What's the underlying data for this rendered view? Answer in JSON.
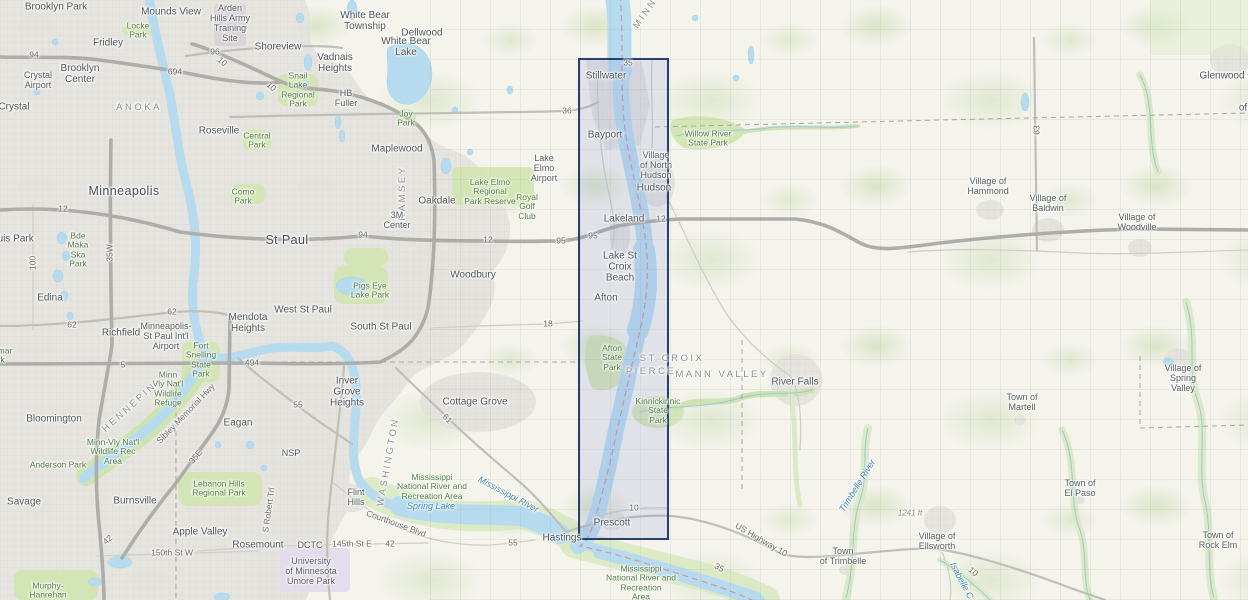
{
  "map": {
    "selection": {
      "border_color": "#24406e",
      "fill_color": "rgba(131,142,212,0.17)"
    },
    "labels": [
      {
        "t": "Brooklyn Park",
        "x": 56,
        "y": 7,
        "c": "city"
      },
      {
        "t": "Mounds View",
        "x": 171,
        "y": 12,
        "c": "city"
      },
      {
        "t": "Arden\nHills Army\nTraining\nSite",
        "x": 230,
        "y": 24,
        "c": "town"
      },
      {
        "t": "Fridley",
        "x": 108,
        "y": 43,
        "c": "city"
      },
      {
        "t": "Locke\nPark",
        "x": 138,
        "y": 31,
        "c": "park"
      },
      {
        "t": "Shoreview",
        "x": 278,
        "y": 47,
        "c": "city"
      },
      {
        "t": "Brooklyn\nCenter",
        "x": 80,
        "y": 74,
        "c": "city"
      },
      {
        "t": "Crystal\nAirport",
        "x": 38,
        "y": 81,
        "c": "town"
      },
      {
        "t": "Crystal",
        "x": 14,
        "y": 107,
        "c": "city"
      },
      {
        "t": "ANOKA",
        "x": 139,
        "y": 108,
        "c": "county"
      },
      {
        "t": "Snail\nLake\nRegional\nPark",
        "x": 298,
        "y": 90,
        "c": "park"
      },
      {
        "t": "White Bear\nTownship",
        "x": 365,
        "y": 21,
        "c": "city"
      },
      {
        "t": "Dellwood",
        "x": 422,
        "y": 33,
        "c": "city"
      },
      {
        "t": "White Bear\nLake",
        "x": 406,
        "y": 47,
        "c": "city"
      },
      {
        "t": "Vadnais\nHeights",
        "x": 335,
        "y": 63,
        "c": "city"
      },
      {
        "t": "HB\nFuller",
        "x": 346,
        "y": 99,
        "c": "town"
      },
      {
        "t": "Joy\nPark",
        "x": 406,
        "y": 119,
        "c": "park"
      },
      {
        "t": "94",
        "x": 34,
        "y": 55,
        "c": "road"
      },
      {
        "t": "694",
        "x": 175,
        "y": 72,
        "c": "road"
      },
      {
        "t": "96",
        "x": 215,
        "y": 52,
        "c": "road"
      },
      {
        "t": "10",
        "x": 222,
        "y": 62,
        "c": "road",
        "r": 40
      },
      {
        "t": "10",
        "x": 271,
        "y": 87,
        "c": "road",
        "r": 40
      },
      {
        "t": "MINN",
        "x": 646,
        "y": 14,
        "c": "county",
        "r": -55
      },
      {
        "t": "35",
        "x": 628,
        "y": 63,
        "c": "road"
      },
      {
        "t": "36",
        "x": 567,
        "y": 111,
        "c": "road"
      },
      {
        "t": "Stillwater",
        "x": 606,
        "y": 76,
        "c": "city"
      },
      {
        "t": "Bayport",
        "x": 605,
        "y": 135,
        "c": "city"
      },
      {
        "t": "Village\nof North\nHudson",
        "x": 656,
        "y": 166,
        "c": "town"
      },
      {
        "t": "Hudson",
        "x": 654,
        "y": 188,
        "c": "city"
      },
      {
        "t": "Willow River\nState Park",
        "x": 708,
        "y": 139,
        "c": "park"
      },
      {
        "t": "Maplewood",
        "x": 397,
        "y": 149,
        "c": "city"
      },
      {
        "t": "Roseville",
        "x": 219,
        "y": 131,
        "c": "city"
      },
      {
        "t": "Central\nPark",
        "x": 257,
        "y": 141,
        "c": "park"
      },
      {
        "t": "Como\nPark",
        "x": 243,
        "y": 197,
        "c": "park"
      },
      {
        "t": "Minneapolis",
        "x": 124,
        "y": 192,
        "c": "city-lg"
      },
      {
        "t": "St Paul",
        "x": 287,
        "y": 241,
        "c": "city-lg"
      },
      {
        "t": "RAMSEY",
        "x": 403,
        "y": 193,
        "c": "county",
        "r": -90
      },
      {
        "t": "Oakdale",
        "x": 437,
        "y": 201,
        "c": "city"
      },
      {
        "t": "Lake Elmo\nRegional\nPark Reserve",
        "x": 490,
        "y": 192,
        "c": "park"
      },
      {
        "t": "Lake\nElmo\nAirport",
        "x": 544,
        "y": 169,
        "c": "town"
      },
      {
        "t": "Royal\nGolf\nClub",
        "x": 527,
        "y": 207,
        "c": "park"
      },
      {
        "t": "3M\nCenter",
        "x": 397,
        "y": 221,
        "c": "town"
      },
      {
        "t": "12",
        "x": 63,
        "y": 209,
        "c": "road"
      },
      {
        "t": "35W",
        "x": 110,
        "y": 253,
        "c": "road",
        "r": -90
      },
      {
        "t": "100",
        "x": 33,
        "y": 263,
        "c": "road",
        "r": -90
      },
      {
        "t": "Bde\nMaka\nSka\nPark",
        "x": 78,
        "y": 250,
        "c": "park"
      },
      {
        "t": "St Louis Park",
        "x": 4,
        "y": 239,
        "c": "city"
      },
      {
        "t": "94",
        "x": 363,
        "y": 235,
        "c": "road"
      },
      {
        "t": "12",
        "x": 488,
        "y": 240,
        "c": "road"
      },
      {
        "t": "95",
        "x": 561,
        "y": 241,
        "c": "road"
      },
      {
        "t": "95",
        "x": 593,
        "y": 236,
        "c": "road"
      },
      {
        "t": "12",
        "x": 661,
        "y": 219,
        "c": "road"
      },
      {
        "t": "Lakeland",
        "x": 624,
        "y": 219,
        "c": "city"
      },
      {
        "t": "Woodbury",
        "x": 473,
        "y": 275,
        "c": "city"
      },
      {
        "t": "Pigs Eye\nLake Park",
        "x": 370,
        "y": 291,
        "c": "park"
      },
      {
        "t": "Lake St\nCroix\nBeach",
        "x": 620,
        "y": 267,
        "c": "city"
      },
      {
        "t": "Edina",
        "x": 50,
        "y": 298,
        "c": "city"
      },
      {
        "t": "62",
        "x": 72,
        "y": 325,
        "c": "road"
      },
      {
        "t": "62",
        "x": 172,
        "y": 312,
        "c": "road"
      },
      {
        "t": "Richfield",
        "x": 121,
        "y": 333,
        "c": "city"
      },
      {
        "t": "Minneapolis-\nSt Paul Int'l\nAirport",
        "x": 166,
        "y": 337,
        "c": "town"
      },
      {
        "t": "Mendota\nHeights",
        "x": 248,
        "y": 323,
        "c": "city"
      },
      {
        "t": "West St Paul",
        "x": 303,
        "y": 310,
        "c": "city"
      },
      {
        "t": "South St Paul",
        "x": 381,
        "y": 327,
        "c": "city"
      },
      {
        "t": "Afton",
        "x": 606,
        "y": 298,
        "c": "city"
      },
      {
        "t": "18",
        "x": 548,
        "y": 324,
        "c": "road"
      },
      {
        "t": "Fort\nSnelling\nState\nPark",
        "x": 201,
        "y": 360,
        "c": "park"
      },
      {
        "t": "Minn\nVly Nat'l\nWildlife\nRefuge",
        "x": 168,
        "y": 389,
        "c": "park"
      },
      {
        "t": "494",
        "x": 252,
        "y": 363,
        "c": "road"
      },
      {
        "t": "5",
        "x": 123,
        "y": 365,
        "c": "road"
      },
      {
        "t": "Braemar\nPark",
        "x": -4,
        "y": 356,
        "c": "park"
      },
      {
        "t": "Inver\nGrove\nHeights",
        "x": 347,
        "y": 392,
        "c": "city"
      },
      {
        "t": "WASHINGTON",
        "x": 389,
        "y": 462,
        "c": "county",
        "r": -80
      },
      {
        "t": "Cottage Grove",
        "x": 475,
        "y": 402,
        "c": "city"
      },
      {
        "t": "ST CROIX",
        "x": 672,
        "y": 359,
        "c": "county"
      },
      {
        "t": "PIERCE",
        "x": 651,
        "y": 372,
        "c": "county"
      },
      {
        "t": "MANN VALLEY",
        "x": 722,
        "y": 375,
        "c": "county"
      },
      {
        "t": "Afton\nState\nPark",
        "x": 612,
        "y": 358,
        "c": "park"
      },
      {
        "t": "River Falls",
        "x": 795,
        "y": 382,
        "c": "city"
      },
      {
        "t": "Kinnickinnic\nState\nPark",
        "x": 658,
        "y": 411,
        "c": "park"
      },
      {
        "t": "Bloomington",
        "x": 54,
        "y": 419,
        "c": "city"
      },
      {
        "t": "HENNEPIN",
        "x": 130,
        "y": 408,
        "c": "county",
        "r": -42
      },
      {
        "t": "Sibley Memorial Hwy",
        "x": 186,
        "y": 414,
        "c": "roadname",
        "r": -46
      },
      {
        "t": "Eagan",
        "x": 238,
        "y": 423,
        "c": "city"
      },
      {
        "t": "Minn-Vly Nat'l\nWildlife Rec\nArea",
        "x": 113,
        "y": 452,
        "c": "park"
      },
      {
        "t": "Anderson Park",
        "x": 58,
        "y": 465,
        "c": "park"
      },
      {
        "t": "NSP",
        "x": 291,
        "y": 454,
        "c": "town"
      },
      {
        "t": "35E",
        "x": 196,
        "y": 457,
        "c": "road",
        "r": -50
      },
      {
        "t": "55",
        "x": 298,
        "y": 405,
        "c": "road"
      },
      {
        "t": "61",
        "x": 447,
        "y": 419,
        "c": "road",
        "r": 45
      },
      {
        "t": "Lebanon Hills\nRegional Park",
        "x": 219,
        "y": 489,
        "c": "park"
      },
      {
        "t": "Savage",
        "x": 24,
        "y": 502,
        "c": "city"
      },
      {
        "t": "Burnsville",
        "x": 135,
        "y": 501,
        "c": "city"
      },
      {
        "t": "Apple Valley",
        "x": 200,
        "y": 532,
        "c": "city"
      },
      {
        "t": "S Robert Trl",
        "x": 269,
        "y": 510,
        "c": "roadname",
        "r": -82
      },
      {
        "t": "Murphy-\nHanrehan",
        "x": 48,
        "y": 591,
        "c": "park"
      },
      {
        "t": "42",
        "x": 108,
        "y": 540,
        "c": "road",
        "r": -40
      },
      {
        "t": "150th St W",
        "x": 172,
        "y": 553,
        "c": "roadname"
      },
      {
        "t": "145th St E",
        "x": 352,
        "y": 544,
        "c": "roadname"
      },
      {
        "t": "42",
        "x": 390,
        "y": 544,
        "c": "road"
      },
      {
        "t": "Rosemount",
        "x": 258,
        "y": 545,
        "c": "city"
      },
      {
        "t": "DCTC",
        "x": 310,
        "y": 546,
        "c": "town"
      },
      {
        "t": "University\nof Minnesota\nUmore Park",
        "x": 311,
        "y": 572,
        "c": "town"
      },
      {
        "t": "Flint\nHills",
        "x": 356,
        "y": 498,
        "c": "town"
      },
      {
        "t": "Courthouse Blvd",
        "x": 396,
        "y": 524,
        "c": "roadname",
        "r": 20
      },
      {
        "t": "55",
        "x": 513,
        "y": 543,
        "c": "road"
      },
      {
        "t": "Spring Lake",
        "x": 431,
        "y": 507,
        "c": "water"
      },
      {
        "t": "Mississippi\nNational River and\nRecreation Area",
        "x": 432,
        "y": 487,
        "c": "park"
      },
      {
        "t": "Mississippi River",
        "x": 508,
        "y": 495,
        "c": "water",
        "r": 28
      },
      {
        "t": "Hastings",
        "x": 562,
        "y": 538,
        "c": "city"
      },
      {
        "t": "Prescott",
        "x": 612,
        "y": 523,
        "c": "city"
      },
      {
        "t": "10",
        "x": 634,
        "y": 508,
        "c": "road"
      },
      {
        "t": "US Highway 10",
        "x": 761,
        "y": 540,
        "c": "roadname",
        "r": 30
      },
      {
        "t": "35",
        "x": 719,
        "y": 568,
        "c": "road",
        "r": 30
      },
      {
        "t": "Mississippi\nNational River and\nRecreation\nArea",
        "x": 641,
        "y": 583,
        "c": "park"
      },
      {
        "t": "Town\nof Trimbelle",
        "x": 843,
        "y": 557,
        "c": "town"
      },
      {
        "t": "Trimbelle River",
        "x": 858,
        "y": 486,
        "c": "water",
        "r": -58
      },
      {
        "t": "1241 ft",
        "x": 910,
        "y": 514,
        "c": "elev"
      },
      {
        "t": "Village of\nEllsworth",
        "x": 937,
        "y": 542,
        "c": "town"
      },
      {
        "t": "Isabelle C",
        "x": 961,
        "y": 581,
        "c": "water",
        "r": 62
      },
      {
        "t": "10",
        "x": 973,
        "y": 572,
        "c": "road",
        "r": 40
      },
      {
        "t": "Town of\nMartell",
        "x": 1022,
        "y": 403,
        "c": "town"
      },
      {
        "t": "Village of\nSpring\nValley",
        "x": 1183,
        "y": 379,
        "c": "town"
      },
      {
        "t": "Town of\nEl Paso",
        "x": 1080,
        "y": 489,
        "c": "town"
      },
      {
        "t": "Town of\nRock Elm",
        "x": 1218,
        "y": 541,
        "c": "town"
      },
      {
        "t": "63",
        "x": 1037,
        "y": 130,
        "c": "road",
        "r": -90
      },
      {
        "t": "Village of\nHammond",
        "x": 988,
        "y": 187,
        "c": "town"
      },
      {
        "t": "Village of\nBaldwin",
        "x": 1048,
        "y": 204,
        "c": "town"
      },
      {
        "t": "Village of\nWoodville",
        "x": 1137,
        "y": 223,
        "c": "town"
      },
      {
        "t": "Glenwood City",
        "x": 1232,
        "y": 76,
        "c": "city"
      },
      {
        "t": "of",
        "x": 1243,
        "y": 108,
        "c": "city"
      }
    ]
  }
}
